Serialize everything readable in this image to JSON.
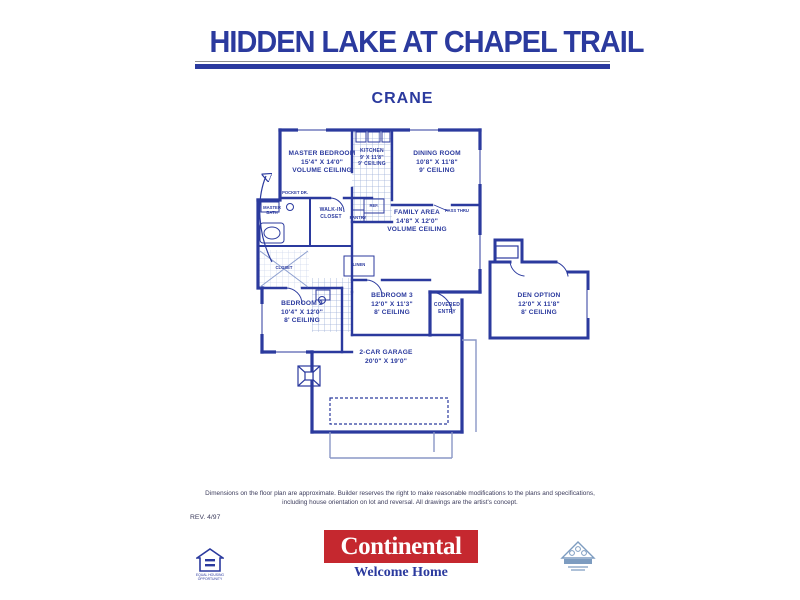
{
  "header": {
    "title": "HIDDEN LAKE AT CHAPEL TRAIL",
    "model": "CRANE"
  },
  "rooms": {
    "master_bedroom": {
      "name": "MASTER BEDROOM",
      "dims": "15'4\" X 14'0\"",
      "ceiling": "VOLUME CEILING"
    },
    "kitchen": {
      "name": "KITCHEN",
      "dims": "9' X 11'8\"",
      "ceiling": "9' CEILING"
    },
    "dining_room": {
      "name": "DINING ROOM",
      "dims": "10'8\" X 11'8\"",
      "ceiling": "9' CEILING"
    },
    "family_area": {
      "name": "FAMILY AREA",
      "dims": "14'8\" X 12'0\"",
      "ceiling": "VOLUME CEILING"
    },
    "bedroom_2": {
      "name": "BEDROOM 2",
      "dims": "10'4\" X 12'0\"",
      "ceiling": "8' CEILING"
    },
    "bedroom_3": {
      "name": "BEDROOM 3",
      "dims": "12'0\" X 11'3\"",
      "ceiling": "8' CEILING"
    },
    "den_option": {
      "name": "DEN OPTION",
      "dims": "12'0\" X 11'8\"",
      "ceiling": "8' CEILING"
    },
    "garage": {
      "name": "2-CAR GARAGE",
      "dims": "20'0\" X 19'0\""
    },
    "covered_entry": {
      "line1": "COVERED",
      "line2": "ENTRY"
    },
    "master_bath": {
      "line1": "MASTER",
      "line2": "BATH"
    },
    "walk_in_closet": {
      "line1": "WALK-IN",
      "line2": "CLOSET"
    },
    "closet": "CLOSET",
    "linen": "LINEN",
    "pantry": "PANTRY",
    "ref": "REF.",
    "pass_thru": "PASS THRU",
    "pocket_door": "POCKET DR."
  },
  "footer": {
    "disclaimer_line1": "Dimensions on the floor plan are approximate. Builder reserves the right to make reasonable modifications to the plans and specifications,",
    "disclaimer_line2": "including house orientation on lot and reversal. All drawings are the artist's concept.",
    "revision": "REV. 4/97",
    "brand": "Continental",
    "tagline": "Welcome Home",
    "equal_housing_line1": "EQUAL HOUSING",
    "equal_housing_line2": "OPPORTUNITY"
  },
  "colors": {
    "plan_blue": "#2b3a9e",
    "brand_red": "#c5282f"
  }
}
